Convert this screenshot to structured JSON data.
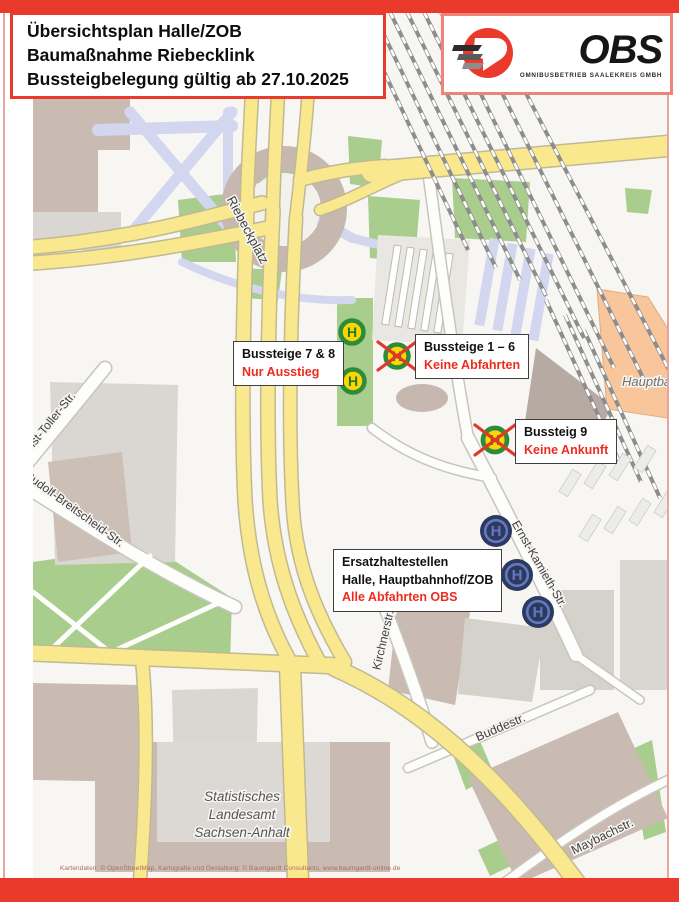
{
  "header": {
    "lines": [
      "Übersichtsplan Halle/ZOB",
      "Baumaßnahme Riebecklink",
      "Bussteigbelegung gültig ab 27.10.2025"
    ]
  },
  "logo": {
    "name": "OBS",
    "subtitle": "OMNIBUSBETRIEB SAALEKREIS GMBH"
  },
  "callouts": {
    "platforms78": {
      "line1": "Bussteige 7 & 8",
      "line2": "Nur Ausstieg"
    },
    "platforms16": {
      "line1": "Bussteige 1 – 6",
      "line2": "Keine Abfahrten"
    },
    "platform9": {
      "line1": "Bussteig 9",
      "line2": "Keine Ankunft"
    },
    "replacement": {
      "line1": "Ersatzhaltestellen",
      "line2": "Halle, Hauptbahnhof/ZOB",
      "line3": "Alle Abfahrten OBS"
    }
  },
  "icons": {
    "letter": "H",
    "bus_stop_meaning": "bus-stop-sign",
    "crossed_meaning": "stop-closed",
    "replacement_meaning": "replacement-stop"
  },
  "streets": {
    "riebeckplatz": "Riebeckplatz",
    "ernst_toller": "Ernst-Toller-Str.",
    "rudolf_breitscheid": "Rudolf-Breitscheid-Str.",
    "kirchnerstr": "Kirchnerstr.",
    "ernst_kamieth": "Ernst-Kamieth-Str.",
    "buddestr": "Buddestr.",
    "maybachstr": "Maybachstr."
  },
  "pois": {
    "hauptbahnhof": "Hauptbahnhof",
    "landesamt_line1": "Statistisches",
    "landesamt_line2": "Landesamt",
    "landesamt_line3": "Sachsen-Anhalt"
  },
  "attribution": {
    "text": "Kartendaten: © OpenStreetMap, Kartografie und Gestaltung: © Baumgardt Consultants, www.baumgardt-online.de"
  },
  "colors": {
    "brand_red": "#e93a2c",
    "warning_text_red": "#ee2c1e",
    "road_yellow": "#f9e88d",
    "park_green": "#a9cd8c",
    "stop_ring_green": "#2c8c3c",
    "stop_fill_yellow": "#fdd500",
    "replacement_navy": "#2d3a60",
    "replacement_blue": "#6478bf",
    "rail_platform_lavender": "#d2d6ee",
    "hauptbahnhof_orange": "#f8c69a"
  }
}
